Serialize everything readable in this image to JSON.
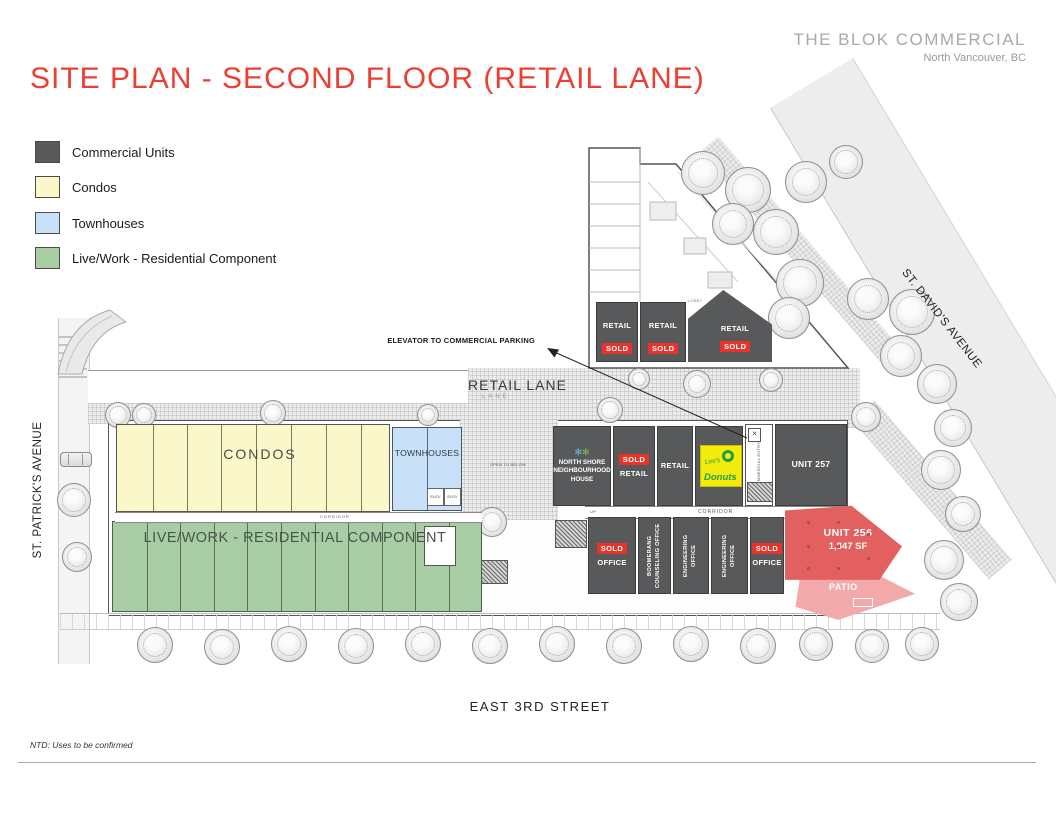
{
  "header": {
    "brand": "THE BLOK COMMERCIAL",
    "location": "North Vancouver, BC"
  },
  "title": "SITE PLAN - SECOND FLOOR (RETAIL LANE)",
  "legend": [
    {
      "label": "Commercial Units",
      "color": "#58595b"
    },
    {
      "label": "Condos",
      "color": "#faf8cb"
    },
    {
      "label": "Townhouses",
      "color": "#c9e1f8"
    },
    {
      "label": "Live/Work - Residential Component",
      "color": "#a8cda5"
    }
  ],
  "streets": {
    "west": "ST. PATRICK'S AVENUE",
    "east": "ST. DAVID'S AVENUE",
    "south": "EAST 3RD STREET",
    "lane": "RETAIL LANE",
    "lane_sub": "LANE"
  },
  "zones": {
    "condos": "CONDOS",
    "townhouses": "TOWNHOUSES",
    "livework": "LIVE/WORK - RESIDENTIAL COMPONENT"
  },
  "top_retail": [
    {
      "label": "RETAIL",
      "status": "SOLD"
    },
    {
      "label": "RETAIL",
      "status": "SOLD"
    },
    {
      "label": "RETAIL",
      "status": "SOLD"
    }
  ],
  "north_row": {
    "nsnh": {
      "line1": "NORTH SHORE",
      "line2": "NEIGHBOURHOOD",
      "line3": "HOUSE"
    },
    "retail_sold": {
      "label": "RETAIL",
      "status": "SOLD"
    },
    "retail": {
      "label": "RETAIL"
    },
    "donuts": {
      "script": "Lee's",
      "name": "Donuts"
    },
    "unit257": "UNIT 257",
    "entry": "COMMERCIAL ENTRY"
  },
  "south_row": [
    {
      "label": "OFFICE",
      "status": "SOLD"
    },
    {
      "label": "BOOMERANG COUNSELING OFFICE"
    },
    {
      "label": "ENGINEERING OFFICE"
    },
    {
      "label": "ENGINEERING OFFICE"
    },
    {
      "label": "OFFICE",
      "status": "SOLD"
    }
  ],
  "unit256": {
    "name": "UNIT 256",
    "area": "1,847 SF",
    "patio": "PATIO"
  },
  "micro": {
    "corridor": "CORRIDOR",
    "lobby": "LOBBY",
    "open_below": "OPEN TO BELOW",
    "elev": "ELEV",
    "up": "UP"
  },
  "annotations": {
    "elevator": "ELEVATOR TO COMMERCIAL PARKING",
    "note": "NTD: Uses to be confirmed"
  },
  "colors": {
    "accent_red": "#ee3e32",
    "sold_red": "#e8332a",
    "commercial_gray": "#58595b",
    "unit256_red": "#e2605f",
    "patio_pink": "#f1a9aa"
  }
}
